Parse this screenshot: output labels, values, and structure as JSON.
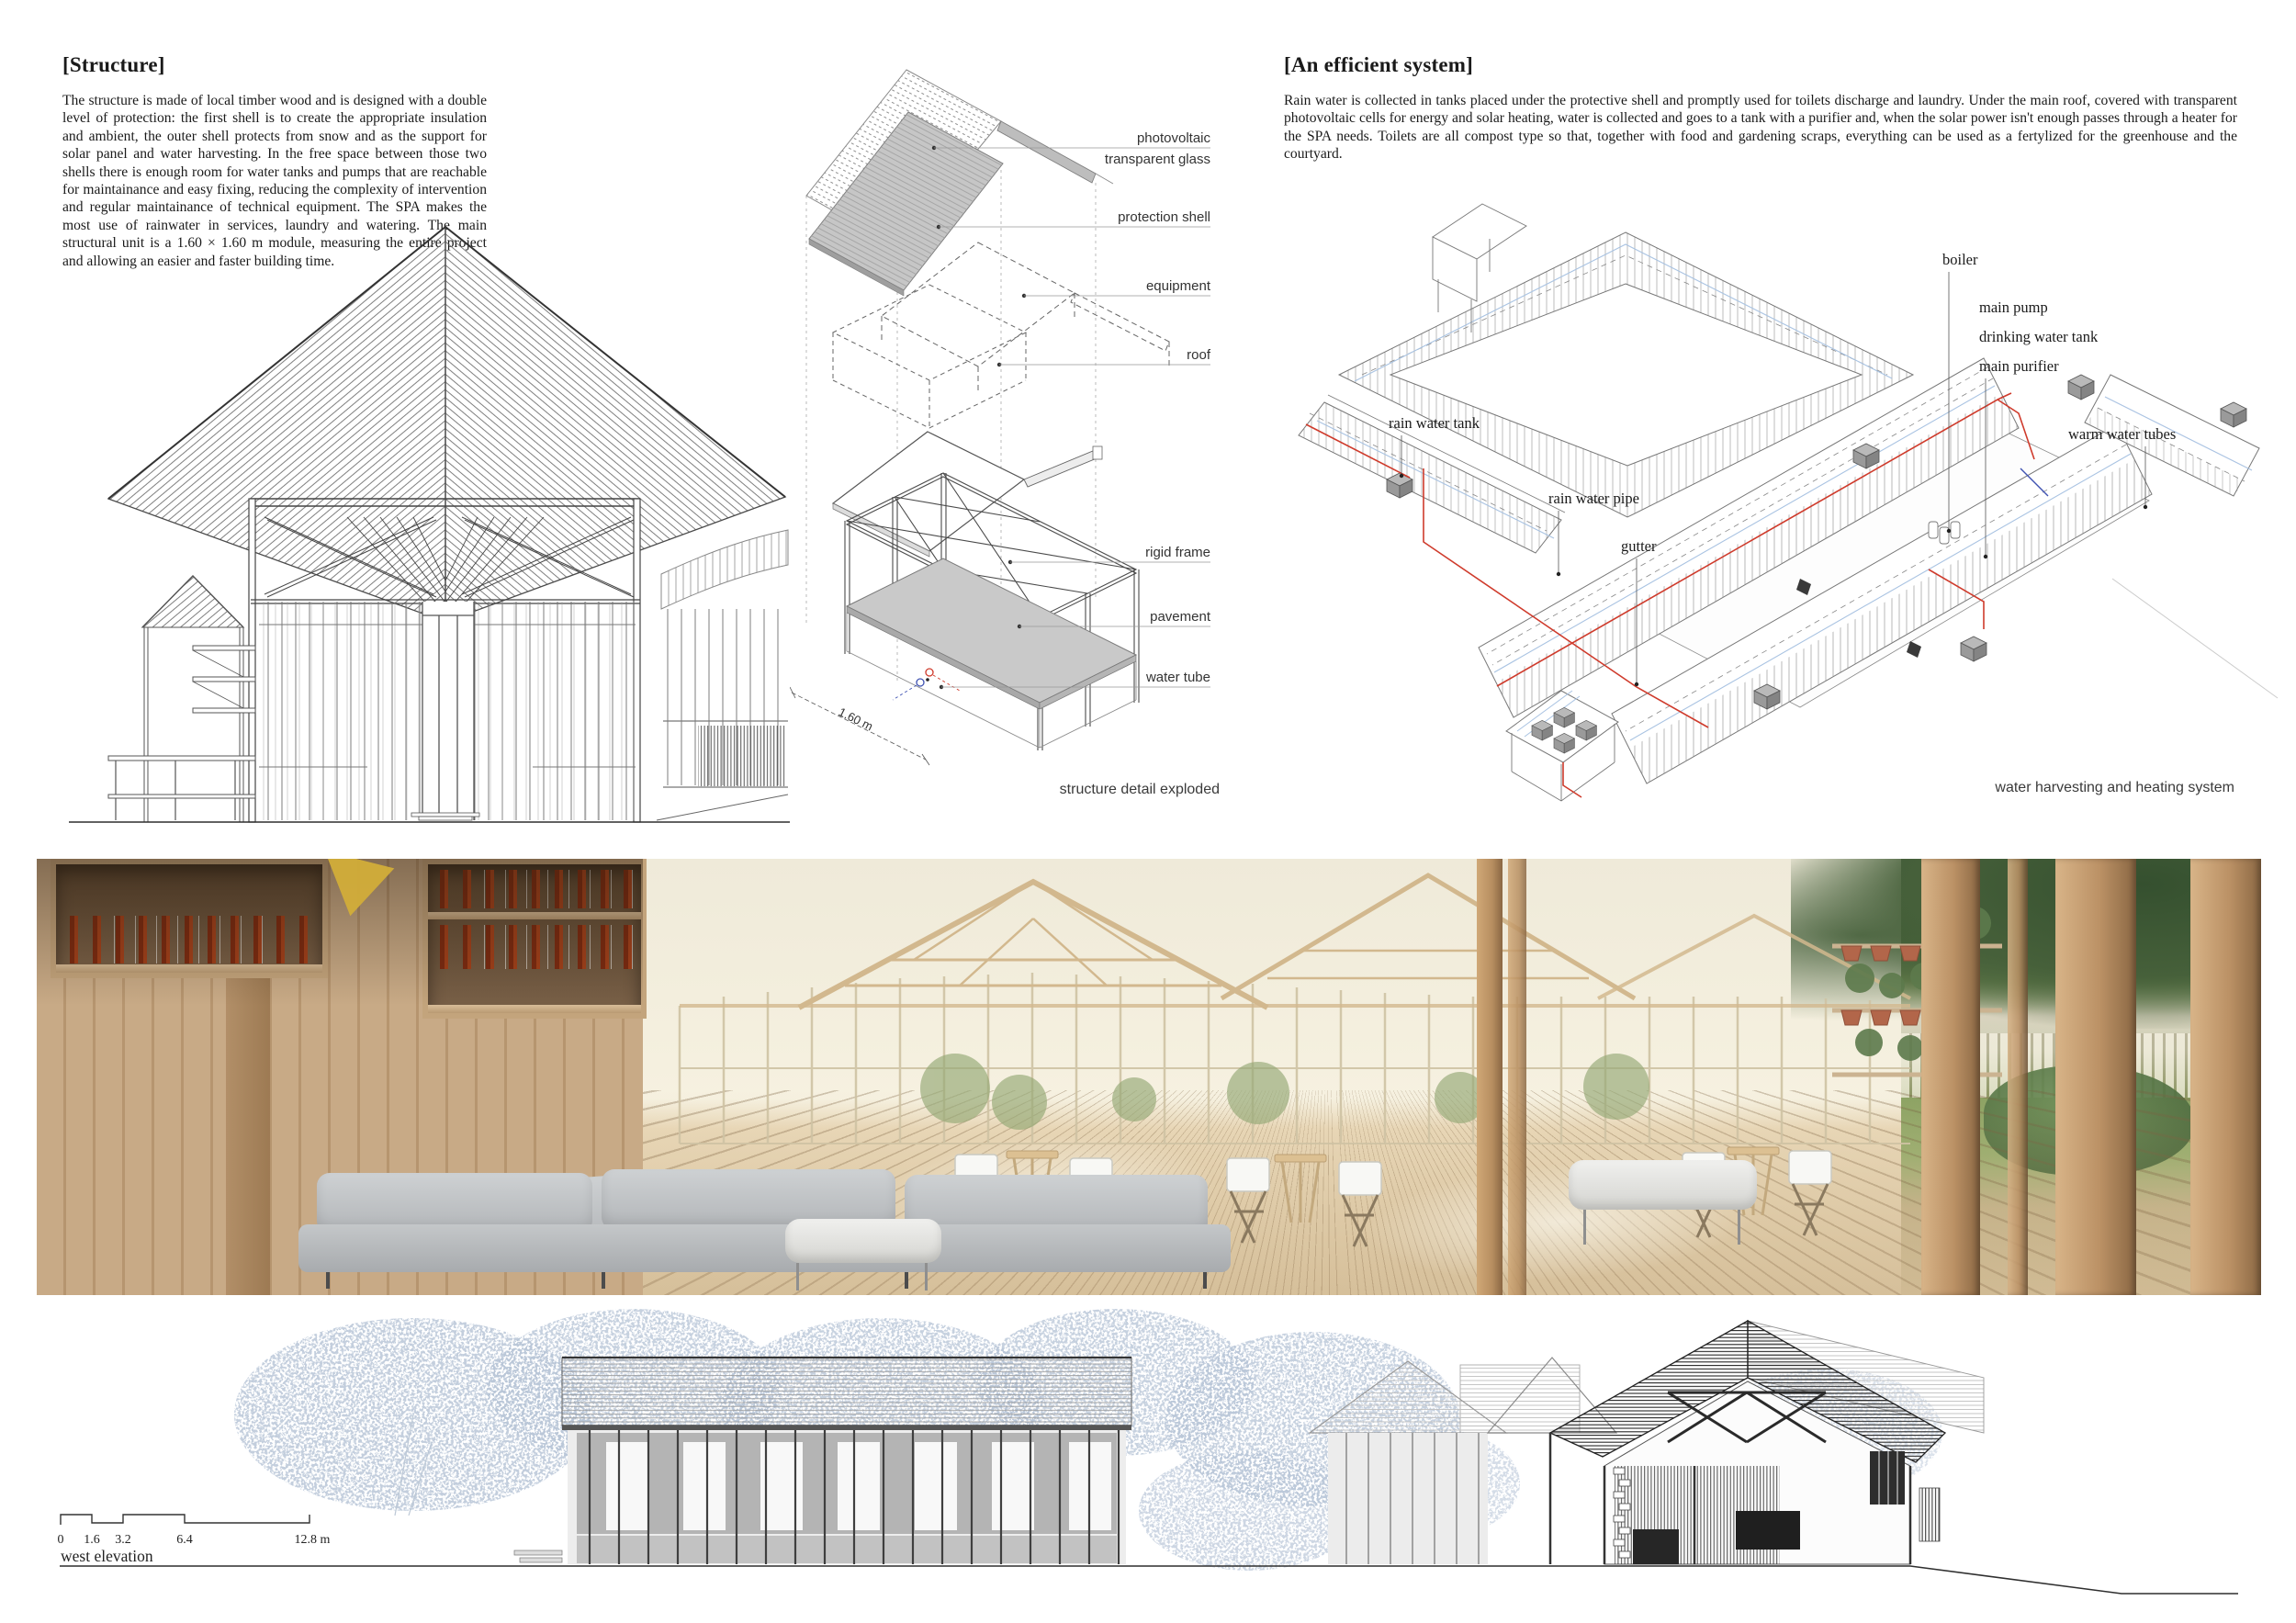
{
  "page": {
    "background": "#ffffff"
  },
  "structure": {
    "heading": "[Structure]",
    "body": "The structure is made of local timber wood and is designed with a double level of protection: the first shell is to create the appropriate insulation and ambient, the outer shell protects from snow and as the support for solar panel and water harvesting. In the free space between those two shells there is enough room for water tanks and pumps that are reachable for maintainance and easy fixing, reducing the complexity of intervention and regular maintainance of technical equipment. The SPA makes the most use of rainwater in services, laundry and watering. The main structural unit is a 1.60 × 1.60 m module, measuring the entire project and allowing an easier and faster building time."
  },
  "efficient_system": {
    "heading": "[An efficient system]",
    "body": "Rain water is collected in tanks placed under the protective shell and promptly used for toilets discharge and laundry. Under the main roof, covered with transparent photovoltaic cells for energy and solar heating, water is collected and goes to a tank with a purifier and, when the solar power isn't enough passes through a heater for the SPA needs. Toilets are all compost type so that, together with food and gardening scraps, everything can be used as a fertylized for the greenhouse and the courtyard."
  },
  "exploded_diagram": {
    "labels": {
      "photovoltaic_1": "photovoltaic",
      "photovoltaic_2": "transparent glass",
      "protection_shell": "protection shell",
      "equipment": "equipment",
      "roof": "roof",
      "rigid_frame": "rigid frame",
      "pavement": "pavement",
      "water_tube": "water tube"
    },
    "dimension": "1.60 m",
    "caption": "structure detail exploded"
  },
  "water_diagram": {
    "labels": {
      "boiler": "boiler",
      "main_pump": "main pump",
      "drinking_water_tank": "drinking water tank",
      "main_purifier": "main purifier",
      "warm_water_tubes": "warm water tubes",
      "rain_water_tank": "rain water tank",
      "rain_water_pipe": "rain water pipe",
      "gutter": "gutter"
    },
    "caption": "water harvesting and heating system",
    "colors": {
      "red_pipe": "#cf3b2c",
      "light_blue_pipe": "#a9c3e2",
      "dark_blue_pipe": "#4053b2"
    }
  },
  "elevation": {
    "scale_ticks": [
      "0",
      "1.6",
      "3.2",
      "6.4",
      "12.8 m"
    ],
    "caption": "west elevation"
  }
}
